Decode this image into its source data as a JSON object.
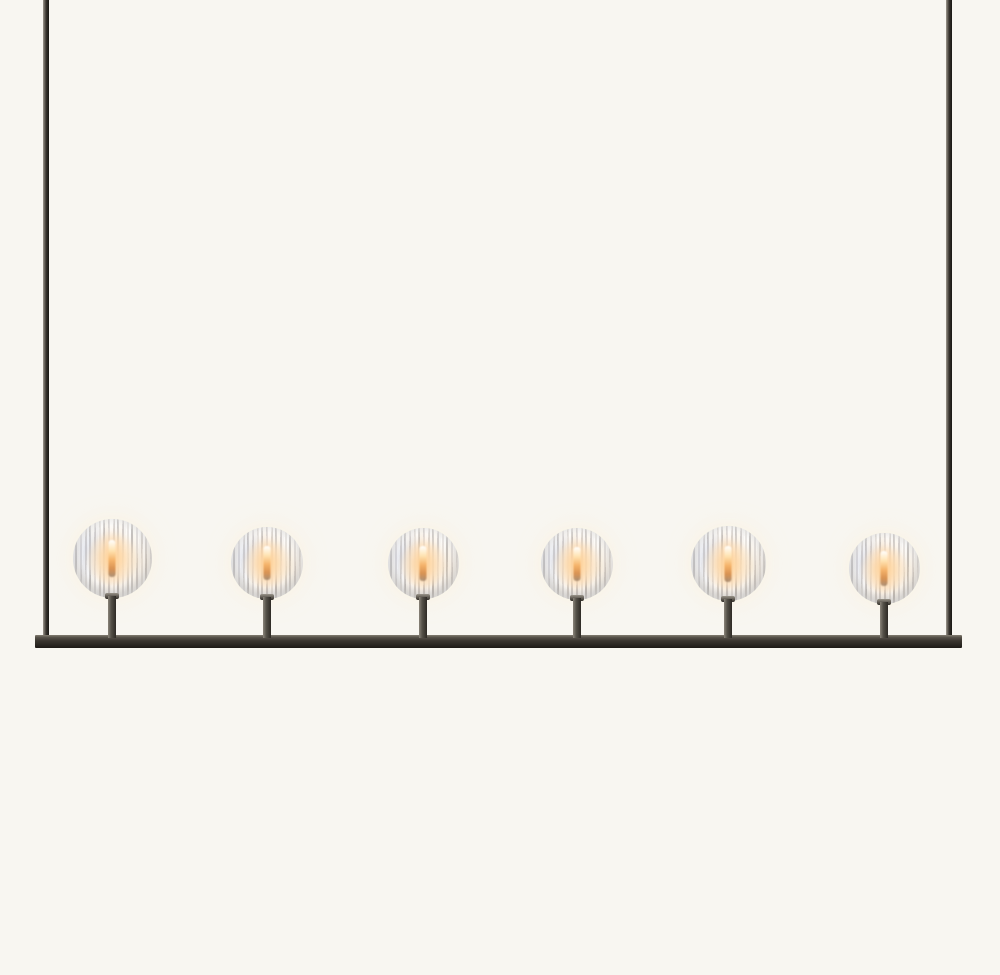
{
  "meta": {
    "type": "product-photograph",
    "subject": "Six-light linear chandelier with faceted crystal ball shades on a dark bronze rectangular frame, lit candelabra bulbs glowing warm inside each crystal sphere",
    "background_color": "#f8f6f1"
  },
  "fixture": {
    "frame_color": "#2e2a26",
    "frame_highlight_color": "#a09a90",
    "glass_color": "#f2efe9",
    "glow_color": "#f4b269",
    "rod_left_x": 43,
    "rod_right_x": 946,
    "rod_width": 6,
    "bar": {
      "x": 35,
      "y": 635,
      "width": 927,
      "height": 13
    },
    "light_count": 6,
    "lights": [
      {
        "x": 112,
        "diameter": 79,
        "bottom": 598
      },
      {
        "x": 267,
        "diameter": 72,
        "bottom": 599
      },
      {
        "x": 423,
        "diameter": 71,
        "bottom": 599
      },
      {
        "x": 577,
        "diameter": 72,
        "bottom": 600
      },
      {
        "x": 728,
        "diameter": 75,
        "bottom": 601
      },
      {
        "x": 884,
        "diameter": 71,
        "bottom": 604
      }
    ]
  }
}
